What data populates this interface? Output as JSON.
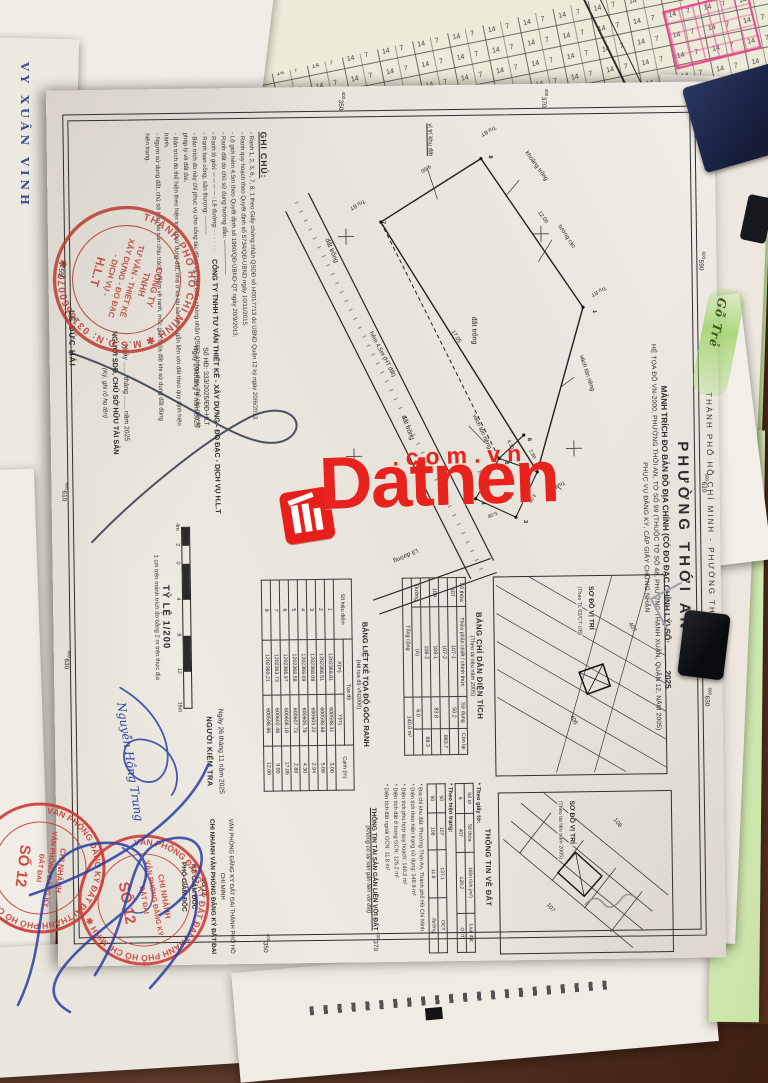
{
  "scene": {
    "watermark": {
      "brand": "Datnen",
      "suffix": ".com.vn",
      "color": "#e8231d"
    },
    "green_tab_text": "Gỗ Trẻ",
    "handwriting_left": "VY XUÂN VINH"
  },
  "doc": {
    "header_line": "THÀNH PHỐ HỒ CHÍ MINH   -   PHƯỜNG THỚI AN",
    "title": {
      "ward": "PHƯỜNG THỚI AN",
      "line1": "MẢNH TRÍCH ĐO BẢN ĐỒ ĐỊA CHÍNH (CÓ ĐO ĐẠC CHỈNH LÝ) SỐ: ..........  2025",
      "line2": "HỆ TỌA ĐỘ VN-2000, PHƯỜNG THỚI AN, TỜ SỐ 99 (THUỘC TỜ SỐ 48, PHƯỜNG THẠNH XUÂN, QUẬN 12, NĂM 2005)",
      "line3": "PHỤC VỤ ĐĂNG KÝ, CẤP GIẤY CHỨNG NHẬN"
    },
    "grid_labels": [
      {
        "e": "t",
        "p": 170,
        "s": "600",
        "m": "590"
      },
      {
        "e": "t",
        "p": 392,
        "s": "600",
        "m": "610"
      },
      {
        "e": "t",
        "p": 606,
        "s": "600",
        "m": "630"
      },
      {
        "e": "b",
        "p": 170,
        "s": "600",
        "m": "590"
      },
      {
        "e": "b",
        "p": 392,
        "s": "600",
        "m": "610"
      },
      {
        "e": "b",
        "p": 560,
        "s": "600",
        "m": "630"
      },
      {
        "e": "l",
        "p": 368,
        "s": "400",
        "m": "350"
      },
      {
        "e": "l",
        "p": 165,
        "s": "400",
        "m": "370"
      },
      {
        "e": "r",
        "p": 345,
        "s": "400",
        "m": "370"
      },
      {
        "e": "r",
        "p": 455,
        "s": "400",
        "m": "350"
      }
    ],
    "plot": {
      "labels": [
        {
          "t": "Trụ BT",
          "x": 6,
          "y": 124,
          "r": 62,
          "s": 5.5
        },
        {
          "t": "Trụ BT",
          "x": 168,
          "y": 16,
          "r": 62,
          "s": 5.5
        },
        {
          "t": "Trụ BT",
          "x": 362,
          "y": 60,
          "r": 62,
          "s": 5.5
        },
        {
          "t": "Trụ BT",
          "x": 78,
          "y": 256,
          "r": 62,
          "s": 5.5
        },
        {
          "t": "tường rào",
          "x": 106,
          "y": 62,
          "r": -33,
          "s": 6
        },
        {
          "t": "vách tôn riêng",
          "x": 236,
          "y": 42,
          "r": -17,
          "s": 6
        },
        {
          "t": "vách tôn riêng",
          "x": 294,
          "y": 150,
          "r": -24,
          "s": 6
        },
        {
          "t": "khoảng trống",
          "x": 32,
          "y": 94,
          "r": -35,
          "s": 6
        },
        {
          "t": "đất trống",
          "x": 196,
          "y": 148,
          "r": 0,
          "s": 7
        },
        {
          "t": "đất trống",
          "x": 294,
          "y": 220,
          "r": -20,
          "s": 6.5
        },
        {
          "t": "đất trống",
          "x": 116,
          "y": 294,
          "r": -22,
          "s": 6.5
        },
        {
          "t": "vị trí khu đất",
          "x": 2,
          "y": 190,
          "r": 0,
          "s": 6,
          "u": 1
        },
        {
          "t": "hẻm 4,5m (HT đất)",
          "x": 210,
          "y": 252,
          "r": -27,
          "s": 6
        },
        {
          "t": "Lề đường",
          "x": 428,
          "y": 208,
          "r": 66,
          "s": 6
        },
        {
          "t": "12.00",
          "x": 92,
          "y": 82,
          "r": -34,
          "s": 5.5
        },
        {
          "t": "17.05",
          "x": 210,
          "y": 170,
          "r": -31,
          "s": 5.5
        },
        {
          "t": "9.00",
          "x": 44,
          "y": 190,
          "r": 58,
          "s": 5.5
        },
        {
          "t": "3.00",
          "x": 374,
          "y": 90,
          "r": 35,
          "s": 5
        },
        {
          "t": "5.08",
          "x": 392,
          "y": 128,
          "r": 70,
          "s": 5
        },
        {
          "t": "2.94",
          "x": 350,
          "y": 146,
          "r": -25,
          "s": 5
        },
        {
          "t": "4.30",
          "x": 320,
          "y": 116,
          "r": -25,
          "s": 5
        },
        {
          "t": "2.80",
          "x": 330,
          "y": 94,
          "r": -25,
          "s": 5
        }
      ],
      "points": [
        {
          "n": "1",
          "x": 188,
          "y": 36
        },
        {
          "n": "2",
          "x": 352,
          "y": 86
        },
        {
          "n": "3",
          "x": 397,
          "y": 108
        },
        {
          "n": "4",
          "x": 378,
          "y": 150
        },
        {
          "n": "5",
          "x": 338,
          "y": 126
        },
        {
          "n": "6",
          "x": 315,
          "y": 103
        },
        {
          "n": "7",
          "x": 96,
          "y": 246
        },
        {
          "n": "8",
          "x": 32,
          "y": 138
        }
      ]
    },
    "ghi_chu": {
      "title": "GHI CHÚ:",
      "lines": [
        "- Ranh 1, 2, 3, 6, 7, 8, 1 theo Giấy chứng nhận QSDĐ số H0017713 do UBND Quận 12 ký ngày 20/6/2013.",
        "- Ranh quy hoạch theo Quyết định số 5734/QĐ-UBND ngày 10/11/2015.",
        "- Lộ giới hẻm 4,5m theo Quyết định số 1960/QĐ-UBND-QT ngày 20/9/2013.",
        "- Ranh đất do chủ sử dụng hướng dẫn: ────────",
        "- Ranh lộ giới: ─ ─ ─ ─        - Lề đường: · · · · · ·",
        "- Ranh ban công, sân thượng: ┄┄┄┄┄",
        "- Bản trích đo này chỉ phục vụ cho công tác đăng ký, cấp Giấy chứng nhận QSDĐ; không thay thế các giấy tờ pháp lý về đất đai.",
        "- Bản trích đo thể hiện theo hiện trạng sử dụng đất; nhà ở và tài sản khác gắn liền với đất theo quy định hiện hành.",
        "- Người sử dụng đất, chủ sở hữu tài sản chịu trách nhiệm về ranh, mốc giới thửa đất khi sử dụng đất đúng hiện trạng."
      ]
    },
    "scale": {
      "title": "TỶ LỆ 1/200",
      "bar_labels": [
        "4m",
        "2",
        "0",
        "4",
        "8",
        "12",
        "16m"
      ],
      "caption": "1 cm trên mảnh trích đo bằng 2 m trên thực địa"
    },
    "sig_company": {
      "l1": "CÔNG TY TNHH TƯ VẤN THIẾT KẾ - XÂY DỰNG - ĐO ĐẠC - DỊCH VỤ H.L.T",
      "l2": "Số HĐ: 333/2025/ĐĐ-HLT",
      "l3": "Ngày 29 tháng 9 năm 2025",
      "name": "LÊ ĐỨC HẢI"
    },
    "sig_user": {
      "l1": "Ngày ....... tháng ....... năm 2025",
      "l2": "NGƯỜI SDĐ, CHỦ SỞ HỮU TÀI SẢN",
      "l3": "(Ký, ghi rõ họ tên)"
    },
    "sig_checker": {
      "l1": "Ngày 26 tháng 11 năm 2025",
      "l2": "NGƯỜI KIỂM TRA",
      "handwritten": "Nguyễn Hồng Trung"
    },
    "sig_registry": {
      "l1": "VĂN PHÒNG ĐĂNG KÝ ĐẤT ĐAI THÀNH PHỐ HỒ CHÍ MINH",
      "l2": "CHI NHÁNH VĂN PHÒNG ĐĂNG KÝ ĐẤT ĐAI SỐ 12",
      "l3": "KT. GIÁM ĐỐC",
      "l4": "PHÓ GIÁM ĐỐC"
    },
    "stamp_hlt": {
      "ring": "THÀNH PHỐ HỒ CHÍ MINH ✱ M.S.D.N: 0313560077 ✱",
      "center": [
        "CÔNG TY",
        "TNHH",
        "TƯ VẤN - THIẾT KẾ",
        "XÂY DỰNG - ĐO ĐẠC",
        "- DỊCH VỤ -",
        "H.L.T"
      ]
    },
    "stamp_12": {
      "ring": "VĂN PHÒNG ĐĂNG KÝ ĐẤT ĐAI THÀNH PHỐ HỒ CHÍ MINH ✱",
      "center": [
        "CHI NHÁNH",
        "VĂN PHÒNG ĐĂNG KÝ",
        "ĐẤT ĐAI"
      ],
      "big": "SỐ 12"
    },
    "tableA": {
      "title": "BẢNG CHỈ DẪN DIỆN TÍCH",
      "subtitle": "(Theo tài liệu năm 2005)",
      "cols": [
        "Số thửa",
        "Thửa phân chiết / chính thức",
        "Sử dụng",
        "Còn lại"
      ],
      "rows": [
        [
          "107",
          "107-1",
          "50.2",
          ""
        ],
        [
          "",
          "107-2",
          "",
          "883.7"
        ],
        [
          "108",
          "108-1",
          "83.8",
          ""
        ],
        [
          "",
          "108-2",
          "",
          "88.3"
        ],
        [
          "Đường",
          "(A)",
          "6.0",
          ""
        ]
      ],
      "total_label": "Tổng cộng",
      "total_value": "140.0 m²"
    },
    "tableB": {
      "title": "BẢNG LIỆT KÊ TỌA ĐỘ GÓC RANH",
      "subtitle": "(Hệ tọa độ VN2000)",
      "col_point": "Số hiệu điểm",
      "col_coord": "Tọa độ",
      "col_x": "X(m)",
      "col_y": "Y(m)",
      "col_edge": "Cạnh (m)",
      "rows": [
        [
          "1",
          "1202369.81",
          "600598.31",
          "3.00"
        ],
        [
          "2",
          "1202368.51",
          "600598.98",
          "5.08"
        ],
        [
          "3",
          "1202368.08",
          "600603.22",
          "2.94"
        ],
        [
          "4",
          "1202369.09",
          "600605.78",
          "4.30"
        ],
        [
          "5",
          "1202368.58",
          "600607.73",
          "2.80"
        ],
        [
          "6",
          "1202366.97",
          "600608.18",
          "17.05"
        ],
        [
          "7",
          "1202363.73",
          "600602.48",
          "9.00"
        ],
        [
          "8",
          "1202360.21",
          "600598.96",
          "12.00"
        ]
      ]
    },
    "info": {
      "title": "THÔNG TIN VỀ ĐẤT",
      "sec1": "* Theo giấy tờ:",
      "cols": [
        "Số tờ",
        "Số thửa",
        "Diện tích (m²)",
        "Loại đất"
      ],
      "rows1": [
        [
          "6",
          "407",
          "128.2",
          "OCT"
        ]
      ],
      "sec2": "* Theo hiện trạng:",
      "rows2": [
        [
          "50",
          "107",
          "137.1",
          "OCT"
        ],
        [
          "50",
          "108",
          "11.8",
          "đường"
        ]
      ],
      "bullets": [
        "Địa chỉ khu đất: Phường Thới An, Thành phố Hồ Chí Minh.",
        "Diện tích theo hiện trạng sử dụng: 148.9 m²",
        "Diện tích phù hợp quy hoạch: 140.2 m²",
        "Diện tích đất ở trong GCN: 125.2 m²",
        "Diện tích đất ngoài GCN: 11.8 m²"
      ],
      "asset_title": "THÔNG TIN TÀI SẢN GẮN LIỀN VỚI ĐẤT",
      "asset_note": "(Không có tài sản gắn liền với đất)"
    },
    "sodo1": {
      "caption": "SƠ ĐỒ VỊ TRÍ",
      "sub": "(Theo TL 02/CT-UB)"
    },
    "sodo2": {
      "caption": "SƠ ĐỒ VỊ TRÍ",
      "sub": "(Theo tài liệu năm 2005)"
    }
  }
}
